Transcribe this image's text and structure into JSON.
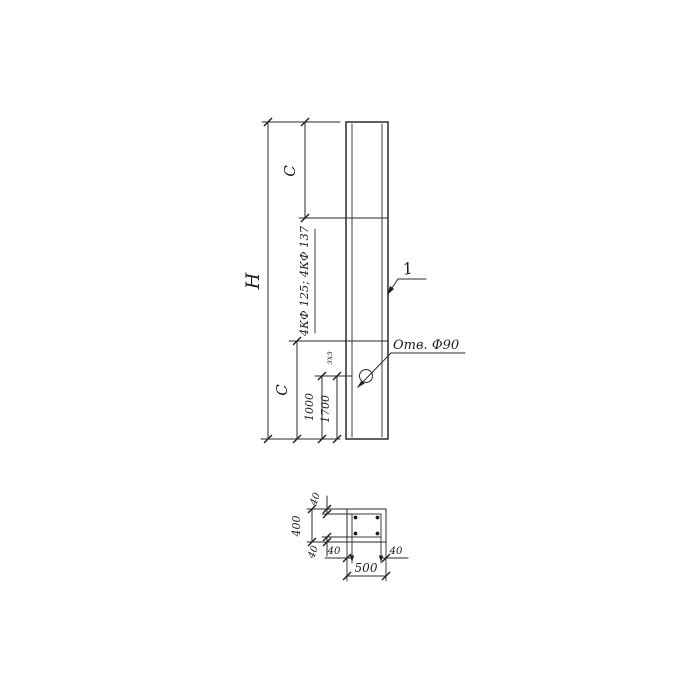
{
  "elevation": {
    "dim_overall": "H",
    "dim_top_segment": "C",
    "dim_bottom_segment": "C",
    "dim_hole_variant_1": "1000",
    "dim_hole_variant_2": "1700",
    "series_note": "4КФ 125; 4КФ 137",
    "small_note": "зхз",
    "item_callout": "1",
    "hole_note": "Отв. Ф90"
  },
  "section": {
    "dim_width_total": "500",
    "dim_height_total": "400",
    "cover_top": "40",
    "cover_bottom": "40",
    "cover_left": "40",
    "cover_right": "40"
  },
  "colors": {
    "ink": "#2a2a2a",
    "paper": "#ffffff"
  }
}
